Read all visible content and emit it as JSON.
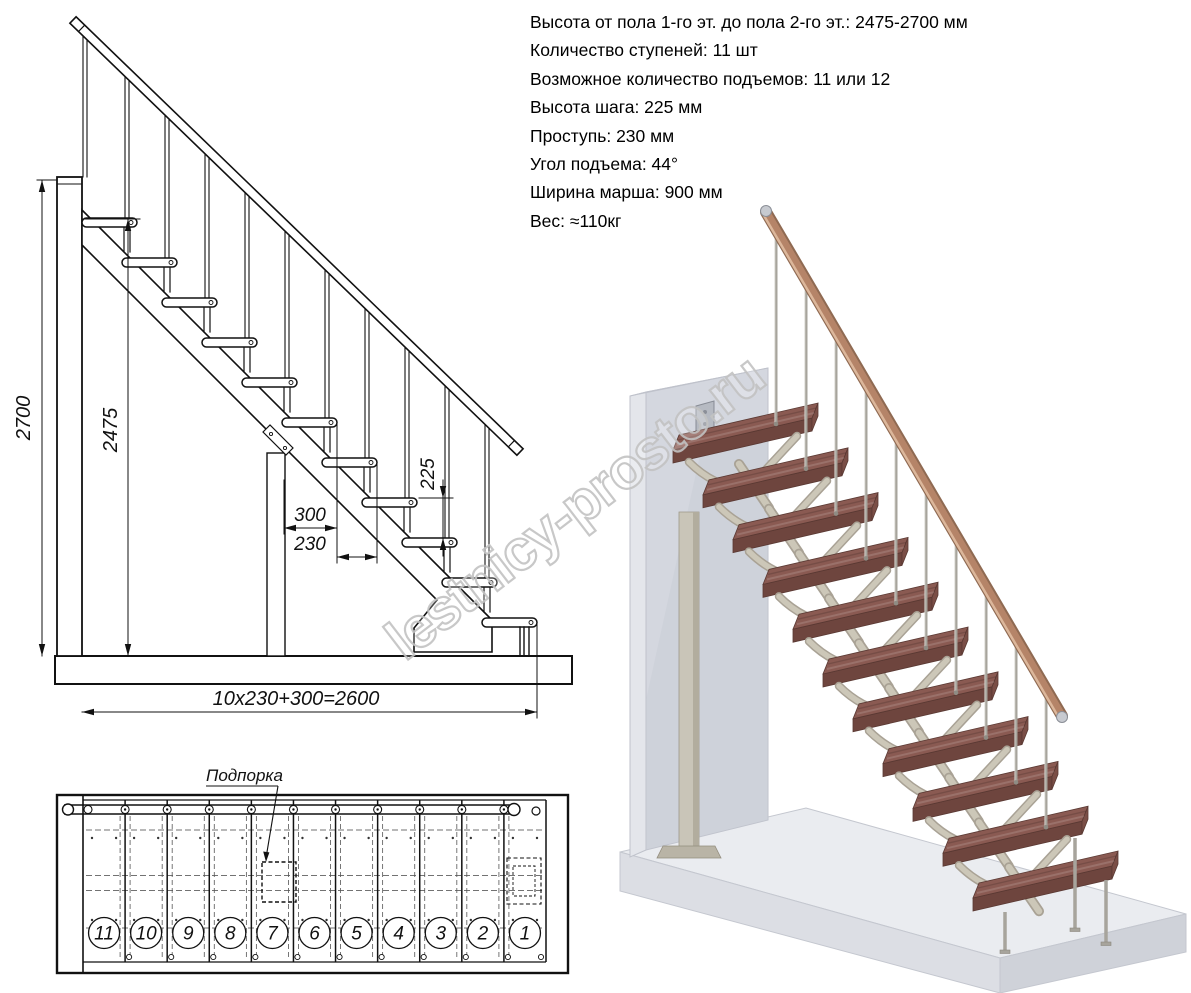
{
  "specs": {
    "lines": [
      "Высота от пола 1-го эт. до пола 2-го эт.: 2475-2700 мм",
      "Количество ступеней: 11 шт",
      "Возможное количество подъемов: 11 или 12",
      "Высота шага: 225 мм",
      "Проступь: 230 мм",
      "Угол подъема: 44°",
      "Ширина марша: 900 мм",
      "Вес: ≈110кг"
    ]
  },
  "side_view": {
    "dims": {
      "total_height": "2700",
      "clear_height": "2475",
      "riser": "225",
      "tread_depth": "300",
      "step_run": "230",
      "total_run": "10x230+300=2600"
    }
  },
  "plan_view": {
    "support_label": "Подпорка",
    "step_numbers": [
      "11",
      "10",
      "9",
      "8",
      "7",
      "6",
      "5",
      "4",
      "3",
      "2",
      "1"
    ]
  },
  "watermark": {
    "text": "lestnicy-prosto.ru"
  },
  "colors": {
    "line": "#1a1a1a",
    "watermark": "#c3c3c3",
    "tread_top": "#8a5a52",
    "tread_front": "#6e453e",
    "tread_side": "#7a4e46",
    "handrail": "#b58468",
    "handrail_dark": "#8f6a52",
    "handrail_light": "#dcb79b",
    "metal": "#a7a49c",
    "metal_light": "#d9d7d1",
    "support": "#ccc7b8",
    "support_dark": "#a9a295",
    "wall": "#d4d7df",
    "wall_light": "#e4e6eb",
    "floor_top": "#eaecf0",
    "floor_front": "#dcdee4",
    "floor_side": "#cfd2d9",
    "column": "#c9c5b8"
  }
}
